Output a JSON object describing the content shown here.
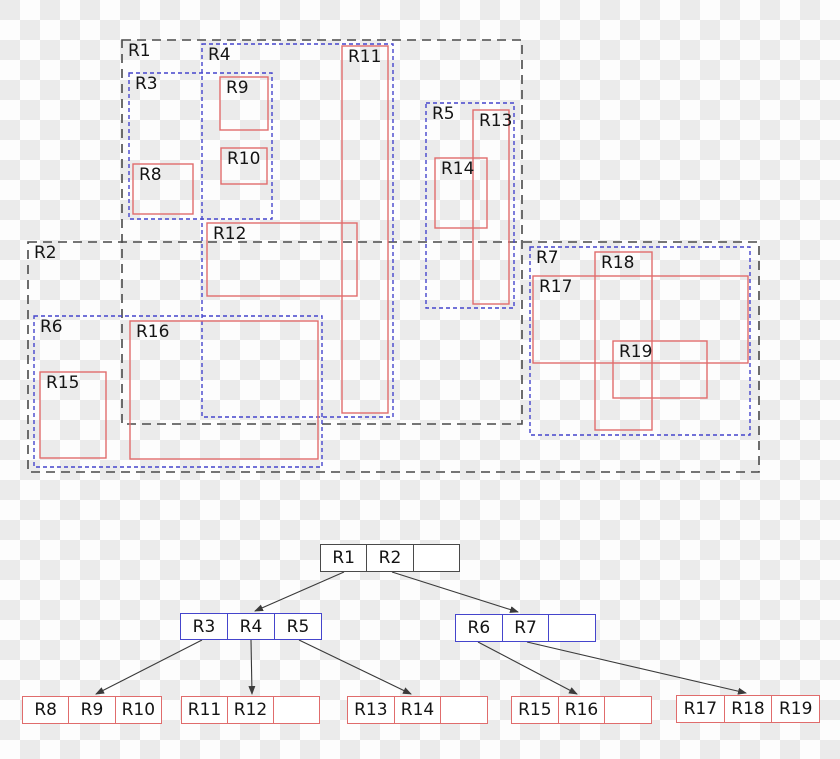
{
  "figure": {
    "description": "R-tree spatial index diagram",
    "background": {
      "checker_light": "#fdfdfd",
      "checker_dark": "#ebebeb",
      "square_px": 20
    },
    "colors": {
      "root_mbr": "#4a4a4a",
      "inner_mbr": "#4545cc",
      "leaf_rect": "#e06c6c",
      "node_fill": "#ffffff",
      "edge": "#3a3a3a",
      "text": "#141414"
    }
  },
  "spatial": {
    "rectangles": [
      {
        "label": "R1",
        "style": "black",
        "x": 122,
        "y": 40,
        "w": 400,
        "h": 384
      },
      {
        "label": "R2",
        "style": "black",
        "x": 28,
        "y": 242,
        "w": 731,
        "h": 230
      },
      {
        "label": "R3",
        "style": "blue",
        "x": 129,
        "y": 73,
        "w": 143,
        "h": 146
      },
      {
        "label": "R4",
        "style": "blue",
        "x": 202,
        "y": 44,
        "w": 191,
        "h": 373
      },
      {
        "label": "R5",
        "style": "blue",
        "x": 426,
        "y": 103,
        "w": 88,
        "h": 205
      },
      {
        "label": "R6",
        "style": "blue",
        "x": 34,
        "y": 316,
        "w": 288,
        "h": 151
      },
      {
        "label": "R7",
        "style": "blue",
        "x": 530,
        "y": 247,
        "w": 220,
        "h": 188
      },
      {
        "label": "R8",
        "style": "red",
        "x": 133,
        "y": 164,
        "w": 60,
        "h": 50
      },
      {
        "label": "R9",
        "style": "red",
        "x": 220,
        "y": 77,
        "w": 48,
        "h": 53
      },
      {
        "label": "R10",
        "style": "red",
        "x": 221,
        "y": 148,
        "w": 46,
        "h": 36
      },
      {
        "label": "R11",
        "style": "red",
        "x": 342,
        "y": 46,
        "w": 46,
        "h": 367
      },
      {
        "label": "R12",
        "style": "red",
        "x": 207,
        "y": 223,
        "w": 150,
        "h": 73
      },
      {
        "label": "R13",
        "style": "red",
        "x": 473,
        "y": 110,
        "w": 36,
        "h": 194
      },
      {
        "label": "R14",
        "style": "red",
        "x": 435,
        "y": 158,
        "w": 52,
        "h": 70
      },
      {
        "label": "R15",
        "style": "red",
        "x": 40,
        "y": 372,
        "w": 66,
        "h": 86
      },
      {
        "label": "R16",
        "style": "red",
        "x": 130,
        "y": 321,
        "w": 188,
        "h": 138
      },
      {
        "label": "R17",
        "style": "red",
        "x": 533,
        "y": 276,
        "w": 215,
        "h": 87
      },
      {
        "label": "R18",
        "style": "red",
        "x": 595,
        "y": 252,
        "w": 57,
        "h": 178
      },
      {
        "label": "R19",
        "style": "red",
        "x": 613,
        "y": 341,
        "w": 94,
        "h": 57
      }
    ]
  },
  "tree": {
    "nodes": [
      {
        "id": "root",
        "style": "black",
        "x": 320,
        "y": 544,
        "w": 140,
        "h": 28,
        "cells": [
          "R1",
          "R2",
          ""
        ]
      },
      {
        "id": "node-r3-r4-r5",
        "style": "blue",
        "x": 180,
        "y": 613,
        "w": 142,
        "h": 27,
        "cells": [
          "R3",
          "R4",
          "R5"
        ]
      },
      {
        "id": "node-r6-r7",
        "style": "blue",
        "x": 455,
        "y": 614,
        "w": 141,
        "h": 28,
        "cells": [
          "R6",
          "R7",
          ""
        ]
      },
      {
        "id": "leaf-r8-r9-r10",
        "style": "red",
        "x": 22,
        "y": 696,
        "w": 140,
        "h": 28,
        "cells": [
          "R8",
          "R9",
          "R10"
        ]
      },
      {
        "id": "leaf-r11-r12",
        "style": "red",
        "x": 181,
        "y": 696,
        "w": 139,
        "h": 28,
        "cells": [
          "R11",
          "R12",
          ""
        ]
      },
      {
        "id": "leaf-r13-r14",
        "style": "red",
        "x": 347,
        "y": 696,
        "w": 141,
        "h": 28,
        "cells": [
          "R13",
          "R14",
          ""
        ]
      },
      {
        "id": "leaf-r15-r16",
        "style": "red",
        "x": 511,
        "y": 696,
        "w": 141,
        "h": 28,
        "cells": [
          "R15",
          "R16",
          ""
        ]
      },
      {
        "id": "leaf-r17-r18-r19",
        "style": "red",
        "x": 676,
        "y": 695,
        "w": 144,
        "h": 28,
        "cells": [
          "R17",
          "R18",
          "R19"
        ]
      }
    ],
    "edges": [
      {
        "from": [
          344,
          572
        ],
        "to": [
          255,
          611
        ]
      },
      {
        "from": [
          392,
          572
        ],
        "to": [
          518,
          612
        ]
      },
      {
        "from": [
          202,
          640
        ],
        "to": [
          96,
          694
        ]
      },
      {
        "from": [
          251,
          640
        ],
        "to": [
          252,
          694
        ]
      },
      {
        "from": [
          299,
          640
        ],
        "to": [
          411,
          694
        ]
      },
      {
        "from": [
          478,
          642
        ],
        "to": [
          577,
          694
        ]
      },
      {
        "from": [
          527,
          642
        ],
        "to": [
          746,
          693
        ]
      }
    ]
  }
}
